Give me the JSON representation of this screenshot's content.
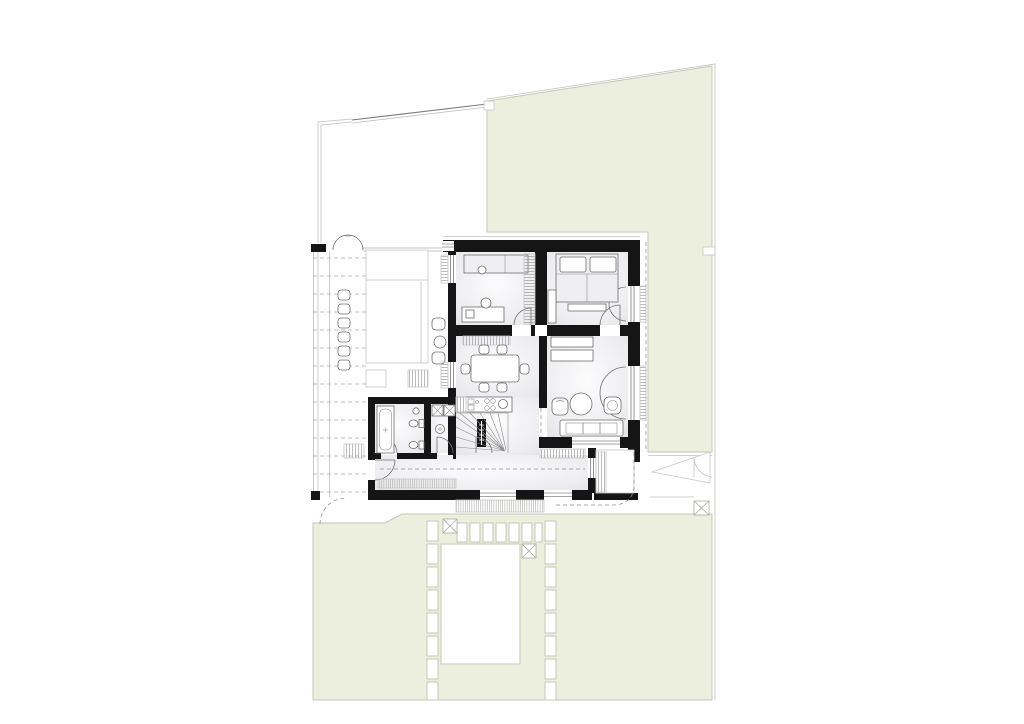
{
  "document": {
    "kind": "architectural site plan with ground-floor layout",
    "text_labels": "none visible"
  },
  "palette": {
    "background": "#ffffff",
    "garden": "#ecefdd",
    "garden_line": "#c3c8b4",
    "lot_line": "#b7b7b2",
    "fence": "#7a7a76",
    "wall": "#151515",
    "line": "#6e6e6e",
    "line_light": "#c7c7c7",
    "pool": "#ffffff",
    "bed_fill": "#efeff2",
    "floor_shade": "#e4e4e8",
    "furniture_fill": "#ffffff"
  },
  "site": {
    "stepping_stones_left": 8,
    "stepping_stones_right": 8,
    "paver_row_count": 7,
    "x_markers_count": 3,
    "pool_present": true
  },
  "house": {
    "dining_chairs": 6,
    "terrace_lounge_chairs": 6,
    "sofa_cushions": 3,
    "washer_dryer_units": 2,
    "toilets": 2
  }
}
